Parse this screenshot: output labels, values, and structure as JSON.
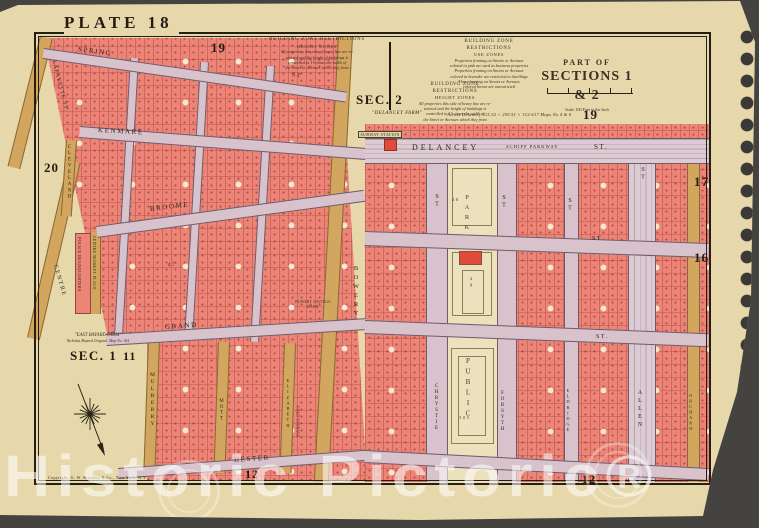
{
  "watermark": {
    "text": "Historic Pictoric®"
  },
  "plate": {
    "title": "PLATE 18"
  },
  "corner_numbers": {
    "top_left": "19",
    "mid_right": "19",
    "left": "20",
    "right_upper": "17",
    "right_lower": "16",
    "sec1_num": "11",
    "bottom_west": "12",
    "bottom_east": "12"
  },
  "sections": {
    "sec2": "SEC. 2",
    "sec1": "SEC. 1"
  },
  "title_block": {
    "part_of": "PART OF",
    "sections": "SECTIONS 1 & 2",
    "scale": "Scale 100 Feet to the Inch"
  },
  "zone_notes": {
    "restrictions_title": "BUILDING ZONE RESTRICTIONS",
    "height_subtitle": "HEIGHT ZONES",
    "use_subtitle": "USE ZONES",
    "height_body": [
      "All properties this side of heavy line are re-",
      "stricted and the height of buildings is",
      "controlled to 1½ times the width of",
      "the Street or Avenues which they front"
    ],
    "use_body": [
      "Properties fronting on Streets or Avenues",
      "colored in pink are used as business properties",
      "Properties fronting on Streets or Avenues",
      "colored in lavender are restricted to dwellings",
      "Those fronting on Streets or Avenues",
      "colored brown are unrestricted"
    ]
  },
  "annotations": {
    "delancey_farm": "\"DELANCEY FARM\"",
    "across_delancey": "Across Delancey 315.32 × 259.51 × 312-617   Maps No 4 & 6",
    "subway_station": "SUBWAY STATION",
    "east_farm": "\"EAST BAYARD FARM\"",
    "east_farm2": "Nicholas Bayard Original. Map No. 361",
    "copyright": "Copyright, G. W. Bromley & Co., New York, N.Y."
  },
  "streets": {
    "spring": "SPRING",
    "spring_st": "ST",
    "kenmare": "KENMARE",
    "broome_w": "BROOME",
    "broome_e_st": "ST",
    "grand_w": "GRAND",
    "grand_e_st": "ST.",
    "hester": "HESTER",
    "delancey": "DELANCEY",
    "schiff": "SCHIFF PARKWAY",
    "delancey_st": "ST.",
    "lafayette": "LAFAYETTE ST.",
    "cleveland": "CLEVELAND",
    "centre": "CENTRE",
    "centre_market": "CENTRE MARKET PLACE",
    "mulberry": "MULBERRY",
    "mott": "MOTT",
    "elizabeth": "ELIZABETH",
    "bowery": "BOWERY",
    "chrystie": "CHRYSTIE",
    "chrystie_st": "ST",
    "forsyth": "FORSYTH",
    "forsyth_st": "ST",
    "eldridge": "ELDRIDGE",
    "eldridge_st": "ST",
    "allen": "ALLEN",
    "allen_st": "ST",
    "orchard": "ORCHARD"
  },
  "park": {
    "name_top": "PARK",
    "name_bottom": "PUBLIC",
    "block_top": "48",
    "block_bottom": "305"
  },
  "buildings": {
    "police": "POLICE HEADQUARTERS",
    "bank": "BOWERY SAVINGS BANK",
    "cold": "COLD STORAGE",
    "block47": "47"
  }
}
